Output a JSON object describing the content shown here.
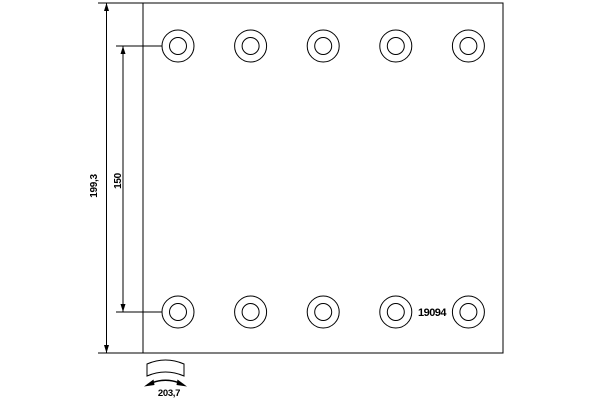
{
  "part_number": "19094",
  "dimensions": {
    "total_height": "199,3",
    "rivet_row_spacing": "150",
    "arc_width": "203,7"
  },
  "rivet_holes": {
    "rows": 2,
    "columns": 5
  },
  "colors": {
    "line": "#000000",
    "background": "#ffffff"
  }
}
